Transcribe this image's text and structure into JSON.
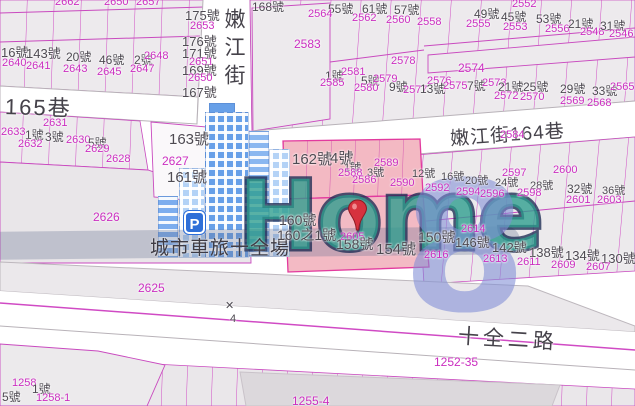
{
  "map": {
    "streets": {
      "vertical_street": "嫩江街",
      "lane_165": "165巷",
      "lane_164": "嫩江街164巷",
      "road_shiquan": "十全二路"
    },
    "landmark": {
      "name": "城市車旅十全場",
      "parking": "P"
    },
    "watermark": {
      "text": "Home",
      "digit": "8"
    },
    "road_point_marker": "4",
    "labels": [
      {
        "t": "2662",
        "x": 55,
        "y": -3,
        "c": "m"
      },
      {
        "t": "2650",
        "x": 104,
        "y": -3,
        "c": "m"
      },
      {
        "t": "2657",
        "x": 136,
        "y": -3,
        "c": "m"
      },
      {
        "t": "16號",
        "x": 1,
        "y": 46,
        "c": "g",
        "s": 13
      },
      {
        "t": "143號",
        "x": 26,
        "y": 47,
        "c": "g",
        "s": 13
      },
      {
        "t": "20號",
        "x": 66,
        "y": 51,
        "c": "g"
      },
      {
        "t": "46號",
        "x": 99,
        "y": 54,
        "c": "g"
      },
      {
        "t": "2號",
        "x": 134,
        "y": 54,
        "c": "g"
      },
      {
        "t": "2640",
        "x": 2,
        "y": 58,
        "c": "m"
      },
      {
        "t": "2641",
        "x": 26,
        "y": 61,
        "c": "m"
      },
      {
        "t": "2643",
        "x": 63,
        "y": 64,
        "c": "m"
      },
      {
        "t": "2645",
        "x": 97,
        "y": 67,
        "c": "m"
      },
      {
        "t": "2647",
        "x": 130,
        "y": 64,
        "c": "m"
      },
      {
        "t": "2648",
        "x": 144,
        "y": 51,
        "c": "m"
      },
      {
        "t": "175號",
        "x": 185,
        "y": 9,
        "c": "g",
        "s": 13
      },
      {
        "t": "2653",
        "x": 190,
        "y": 21,
        "c": "m"
      },
      {
        "t": "176號",
        "x": 182,
        "y": 35,
        "c": "g",
        "s": 13
      },
      {
        "t": "171號",
        "x": 182,
        "y": 47,
        "c": "g",
        "s": 13
      },
      {
        "t": "2651",
        "x": 189,
        "y": 57,
        "c": "m"
      },
      {
        "t": "169號",
        "x": 182,
        "y": 64,
        "c": "g",
        "s": 13
      },
      {
        "t": "2650",
        "x": 188,
        "y": 73,
        "c": "m"
      },
      {
        "t": "167號",
        "x": 182,
        "y": 86,
        "c": "g",
        "s": 13
      },
      {
        "t": "2631",
        "x": 43,
        "y": 118,
        "c": "m"
      },
      {
        "t": "2633",
        "x": 1,
        "y": 127,
        "c": "m"
      },
      {
        "t": "1號",
        "x": 25,
        "y": 129,
        "c": "g"
      },
      {
        "t": "3號",
        "x": 45,
        "y": 131,
        "c": "g"
      },
      {
        "t": "2632",
        "x": 18,
        "y": 139,
        "c": "m"
      },
      {
        "t": "2630",
        "x": 66,
        "y": 135,
        "c": "m"
      },
      {
        "t": "5號",
        "x": 88,
        "y": 137,
        "c": "g"
      },
      {
        "t": "2629",
        "x": 85,
        "y": 144,
        "c": "m"
      },
      {
        "t": "2628",
        "x": 106,
        "y": 154,
        "c": "m"
      },
      {
        "t": "163號",
        "x": 169,
        "y": 132,
        "c": "g",
        "s": 15
      },
      {
        "t": "2627",
        "x": 162,
        "y": 155,
        "c": "m",
        "s": 12
      },
      {
        "t": "161號",
        "x": 167,
        "y": 170,
        "c": "g",
        "s": 15
      },
      {
        "t": "2626",
        "x": 93,
        "y": 211,
        "c": "m",
        "s": 12
      },
      {
        "t": "2625",
        "x": 138,
        "y": 282,
        "c": "m",
        "s": 12
      },
      {
        "t": "168號",
        "x": 252,
        "y": 1,
        "c": "g"
      },
      {
        "t": "55號",
        "x": 328,
        "y": 3,
        "c": "g"
      },
      {
        "t": "61號",
        "x": 362,
        "y": 3,
        "c": "g"
      },
      {
        "t": "57號",
        "x": 394,
        "y": 4,
        "c": "g"
      },
      {
        "t": "2564",
        "x": 308,
        "y": 9,
        "c": "m"
      },
      {
        "t": "2562",
        "x": 352,
        "y": 13,
        "c": "m"
      },
      {
        "t": "2560",
        "x": 386,
        "y": 15,
        "c": "m"
      },
      {
        "t": "2558",
        "x": 417,
        "y": 17,
        "c": "m"
      },
      {
        "t": "2583",
        "x": 294,
        "y": 38,
        "c": "m",
        "s": 12
      },
      {
        "t": "2578",
        "x": 391,
        "y": 56,
        "c": "m"
      },
      {
        "t": "1號",
        "x": 325,
        "y": 70,
        "c": "g"
      },
      {
        "t": "2581",
        "x": 341,
        "y": 67,
        "c": "m"
      },
      {
        "t": "2585",
        "x": 320,
        "y": 78,
        "c": "m"
      },
      {
        "t": "5號",
        "x": 361,
        "y": 75,
        "c": "g"
      },
      {
        "t": "2579",
        "x": 373,
        "y": 74,
        "c": "m"
      },
      {
        "t": "2580",
        "x": 354,
        "y": 83,
        "c": "m"
      },
      {
        "t": "9號",
        "x": 389,
        "y": 81,
        "c": "g"
      },
      {
        "t": "2577",
        "x": 403,
        "y": 85,
        "c": "m"
      },
      {
        "t": "2552",
        "x": 512,
        "y": -1,
        "c": "m"
      },
      {
        "t": "49號",
        "x": 474,
        "y": 8,
        "c": "g"
      },
      {
        "t": "45號",
        "x": 501,
        "y": 11,
        "c": "g"
      },
      {
        "t": "53號",
        "x": 536,
        "y": 13,
        "c": "g"
      },
      {
        "t": "2555",
        "x": 466,
        "y": 19,
        "c": "m"
      },
      {
        "t": "2553",
        "x": 503,
        "y": 22,
        "c": "m"
      },
      {
        "t": "2556",
        "x": 545,
        "y": 24,
        "c": "m"
      },
      {
        "t": "21號",
        "x": 568,
        "y": 18,
        "c": "g"
      },
      {
        "t": "2548",
        "x": 580,
        "y": 27,
        "c": "m"
      },
      {
        "t": "31號",
        "x": 600,
        "y": 20,
        "c": "g"
      },
      {
        "t": "2546",
        "x": 609,
        "y": 29,
        "c": "m"
      },
      {
        "t": "2574",
        "x": 458,
        "y": 62,
        "c": "m",
        "s": 12
      },
      {
        "t": "2576",
        "x": 427,
        "y": 76,
        "c": "m"
      },
      {
        "t": "13號",
        "x": 420,
        "y": 83,
        "c": "g"
      },
      {
        "t": "2575",
        "x": 443,
        "y": 81,
        "c": "m"
      },
      {
        "t": "7號",
        "x": 467,
        "y": 80,
        "c": "g"
      },
      {
        "t": "2573",
        "x": 482,
        "y": 78,
        "c": "m"
      },
      {
        "t": "21號",
        "x": 498,
        "y": 81,
        "c": "g"
      },
      {
        "t": "2572",
        "x": 494,
        "y": 91,
        "c": "m"
      },
      {
        "t": "25號",
        "x": 523,
        "y": 81,
        "c": "g"
      },
      {
        "t": "2570",
        "x": 520,
        "y": 92,
        "c": "m"
      },
      {
        "t": "29號",
        "x": 560,
        "y": 83,
        "c": "g"
      },
      {
        "t": "2569",
        "x": 560,
        "y": 96,
        "c": "m"
      },
      {
        "t": "33號",
        "x": 592,
        "y": 85,
        "c": "g"
      },
      {
        "t": "2568",
        "x": 587,
        "y": 98,
        "c": "m"
      },
      {
        "t": "2565",
        "x": 610,
        "y": 82,
        "c": "m"
      },
      {
        "t": "2584",
        "x": 500,
        "y": 130,
        "c": "m"
      },
      {
        "t": "162號",
        "x": 292,
        "y": 152,
        "c": "g",
        "s": 15
      },
      {
        "t": "4號",
        "x": 330,
        "y": 151,
        "c": "g",
        "s": 15
      },
      {
        "t": "2589",
        "x": 374,
        "y": 158,
        "c": "m"
      },
      {
        "t": "1號",
        "x": 344,
        "y": 163,
        "c": "g",
        "s": 11
      },
      {
        "t": "2588",
        "x": 338,
        "y": 168,
        "c": "m"
      },
      {
        "t": "3號",
        "x": 367,
        "y": 168,
        "c": "g",
        "s": 11
      },
      {
        "t": "2586",
        "x": 352,
        "y": 175,
        "c": "m"
      },
      {
        "t": "2590",
        "x": 390,
        "y": 178,
        "c": "m"
      },
      {
        "t": "12號",
        "x": 412,
        "y": 169,
        "c": "g",
        "s": 11
      },
      {
        "t": "160號",
        "x": 279,
        "y": 213,
        "c": "g",
        "s": 14
      },
      {
        "t": "160之1號",
        "x": 277,
        "y": 228,
        "c": "g",
        "s": 14
      },
      {
        "t": "2605",
        "x": 340,
        "y": 232,
        "c": "m"
      },
      {
        "t": "158號",
        "x": 336,
        "y": 237,
        "c": "g",
        "s": 14
      },
      {
        "t": "154號",
        "x": 376,
        "y": 242,
        "c": "g",
        "s": 15
      },
      {
        "t": "16號",
        "x": 441,
        "y": 172,
        "c": "g",
        "s": 11
      },
      {
        "t": "20號",
        "x": 465,
        "y": 176,
        "c": "g",
        "s": 11
      },
      {
        "t": "24號",
        "x": 495,
        "y": 178,
        "c": "g",
        "s": 11
      },
      {
        "t": "28號",
        "x": 530,
        "y": 181,
        "c": "g",
        "s": 11
      },
      {
        "t": "32號",
        "x": 567,
        "y": 183,
        "c": "g"
      },
      {
        "t": "36號",
        "x": 602,
        "y": 186,
        "c": "g",
        "s": 11
      },
      {
        "t": "2592",
        "x": 425,
        "y": 183,
        "c": "m"
      },
      {
        "t": "2594",
        "x": 456,
        "y": 187,
        "c": "m"
      },
      {
        "t": "2596",
        "x": 480,
        "y": 189,
        "c": "m"
      },
      {
        "t": "2597",
        "x": 502,
        "y": 168,
        "c": "m"
      },
      {
        "t": "2598",
        "x": 517,
        "y": 188,
        "c": "m"
      },
      {
        "t": "2600",
        "x": 553,
        "y": 165,
        "c": "m"
      },
      {
        "t": "2601",
        "x": 566,
        "y": 195,
        "c": "m"
      },
      {
        "t": "2603",
        "x": 597,
        "y": 195,
        "c": "m"
      },
      {
        "t": "150號",
        "x": 418,
        "y": 230,
        "c": "g",
        "s": 14
      },
      {
        "t": "2614",
        "x": 461,
        "y": 224,
        "c": "m"
      },
      {
        "t": "2616",
        "x": 424,
        "y": 250,
        "c": "m"
      },
      {
        "t": "146號",
        "x": 455,
        "y": 236,
        "c": "g",
        "s": 13
      },
      {
        "t": "142號",
        "x": 492,
        "y": 241,
        "c": "g",
        "s": 13
      },
      {
        "t": "2613",
        "x": 483,
        "y": 254,
        "c": "m"
      },
      {
        "t": "138號",
        "x": 529,
        "y": 246,
        "c": "g",
        "s": 13
      },
      {
        "t": "2611",
        "x": 517,
        "y": 257,
        "c": "m"
      },
      {
        "t": "134號",
        "x": 565,
        "y": 249,
        "c": "g",
        "s": 13
      },
      {
        "t": "2609",
        "x": 551,
        "y": 260,
        "c": "m"
      },
      {
        "t": "130號",
        "x": 601,
        "y": 252,
        "c": "g",
        "s": 13
      },
      {
        "t": "2607",
        "x": 586,
        "y": 262,
        "c": "m"
      },
      {
        "t": "✕",
        "x": 225,
        "y": 301,
        "c": "g",
        "s": 11
      },
      {
        "t": "4",
        "x": 230,
        "y": 314,
        "c": "g",
        "s": 11
      },
      {
        "t": "1252-35",
        "x": 434,
        "y": 356,
        "c": "m",
        "s": 12
      },
      {
        "t": "1258",
        "x": 12,
        "y": 378,
        "c": "m"
      },
      {
        "t": "1號",
        "x": 32,
        "y": 383,
        "c": "g"
      },
      {
        "t": "5號",
        "x": 2,
        "y": 391,
        "c": "g"
      },
      {
        "t": "1258-1",
        "x": 36,
        "y": 393,
        "c": "m"
      },
      {
        "t": "1255-4",
        "x": 292,
        "y": 395,
        "c": "m",
        "s": 12
      }
    ]
  },
  "colors": {
    "lot_number_text": "#cb2ec0",
    "parcel_line": "#d04ac4",
    "parcel_fill": "#edeaed",
    "highlight_parcel_fill": "#f3bac4",
    "highlight_parcel_border": "#e23a9e",
    "address_text": "#4e4a52",
    "watermark_teal": "#2c9c8d",
    "watermark_blue": "#808dd6",
    "building_blue": "#68a0e8",
    "parking_sign_blue": "#2e6fd8",
    "pin_red": "#d6323e"
  }
}
